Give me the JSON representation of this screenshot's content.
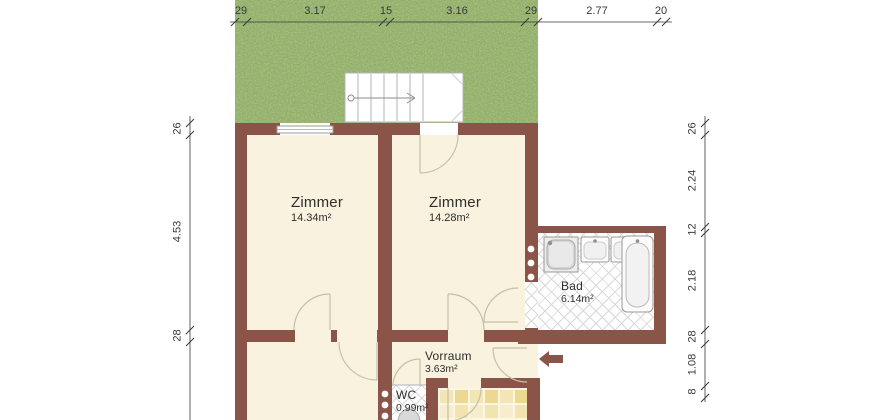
{
  "plan": {
    "rooms": {
      "zimmer1": {
        "name": "Zimmer",
        "area": "14.34m²"
      },
      "zimmer2": {
        "name": "Zimmer",
        "area": "14.28m²"
      },
      "bad": {
        "name": "Bad",
        "area": "6.14m²"
      },
      "vorraum": {
        "name": "Vorraum",
        "area": "3.63m²"
      },
      "wc": {
        "name": "WC",
        "area": "0.99m²"
      }
    },
    "dimensions": {
      "top": [
        "29",
        "3.17",
        "15",
        "3.16",
        "29",
        "2.77",
        "20"
      ],
      "left": [
        "26",
        "4.53",
        "28"
      ],
      "right": [
        "26",
        "2.24",
        "12",
        "2.18",
        "28",
        "1.08",
        "8"
      ]
    },
    "fixtures": [
      "staircase",
      "shower",
      "sink",
      "sink",
      "bathtub",
      "toilet",
      "radiator-dots",
      "entrance-arrow",
      "window",
      "door-swings",
      "garden-grass"
    ],
    "colors": {
      "wall": "#8a5548",
      "floor": "#f8f2de",
      "grass": "#8fac62",
      "bath-tile-line": "#d8d8d8",
      "kitchen-tile": "#ecd88f",
      "door-line": "#c6bfa8",
      "dim": "#3a3a3a"
    }
  }
}
